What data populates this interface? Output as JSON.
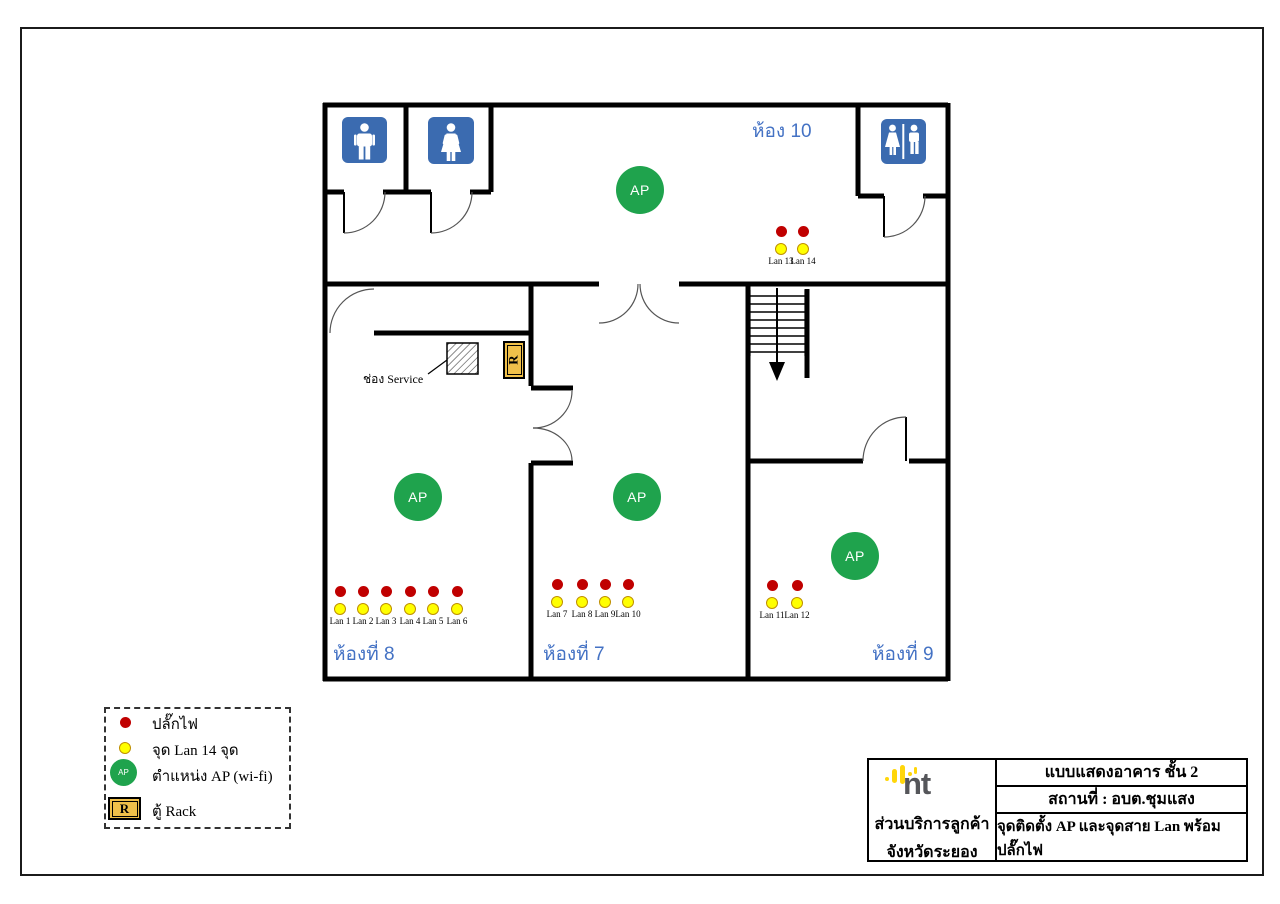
{
  "plan": {
    "ap_label": "AP",
    "room_labels": {
      "room10": "ห้อง 10",
      "room8": "ห้องที่ 8",
      "room7": "ห้องที่ 7",
      "room9": "ห้องที่ 9"
    },
    "service_label": "ช่อง Service",
    "rack_letter": "R",
    "lan_points": [
      "Lan 1",
      "Lan 2",
      "Lan 3",
      "Lan 4",
      "Lan 5",
      "Lan 6",
      "Lan 7",
      "Lan 8",
      "Lan 9",
      "Lan 10",
      "Lan 11",
      "Lan 12",
      "Lan 13",
      "Lan 14"
    ],
    "colors": {
      "wall": "#000000",
      "room_label_blue": "#4472C4",
      "restroom_sign_blue": "#3B6BB0",
      "ap_green": "#1FA34D",
      "plug_red": "#C00000",
      "lan_yellow": "#FFFF00",
      "rack_yellow": "#F0C04A"
    }
  },
  "legend": {
    "items": [
      "ปลั๊กไฟ",
      "จุด Lan 14 จุด",
      "ตำแหน่ง AP (wi-fi)",
      "ตู้ Rack"
    ],
    "ap_text": "AP",
    "rack_letter": "R"
  },
  "title_block": {
    "logo_text": "nt",
    "org_line1": "ส่วนบริการลูกค้า",
    "org_line2": "จังหวัดระยอง",
    "rows": [
      "แบบแสดงอาคาร ชั้น 2",
      "สถานที่ :  อบต.ชุมแสง",
      "จุดติดตั้ง AP และจุดสาย Lan พร้อมปลั๊กไฟ"
    ]
  }
}
